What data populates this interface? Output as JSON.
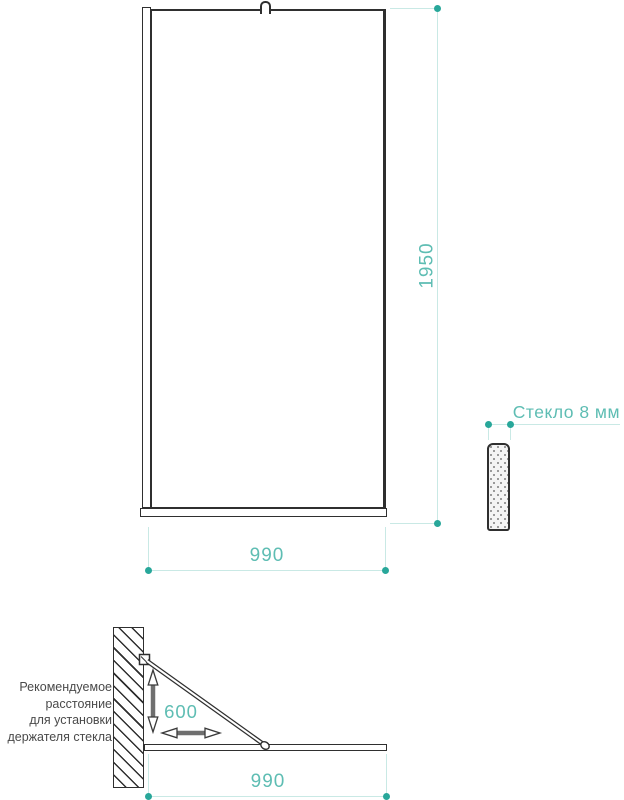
{
  "colors": {
    "ink": "#2f2f2f",
    "dimension_text": "#5ebdb3",
    "dimension_dot": "#28a79a",
    "dimension_line": "#c9e9e5",
    "note_text": "#4a4a4a",
    "arrow_gray": "#6f6f6f"
  },
  "front_view": {
    "height_dim": "1950",
    "width_dim": "990"
  },
  "side_view": {
    "thickness_label": "Стекло 8 мм"
  },
  "plan_view": {
    "width_dim": "990",
    "holder_distance_dim": "600",
    "note": {
      "line1": "Рекомендуемое",
      "line2": "расстояние",
      "line3": "для установки",
      "line4": "держателя стекла"
    }
  },
  "icons": {
    "vertical_double_arrow": "↕",
    "horizontal_double_arrow": "↔"
  }
}
